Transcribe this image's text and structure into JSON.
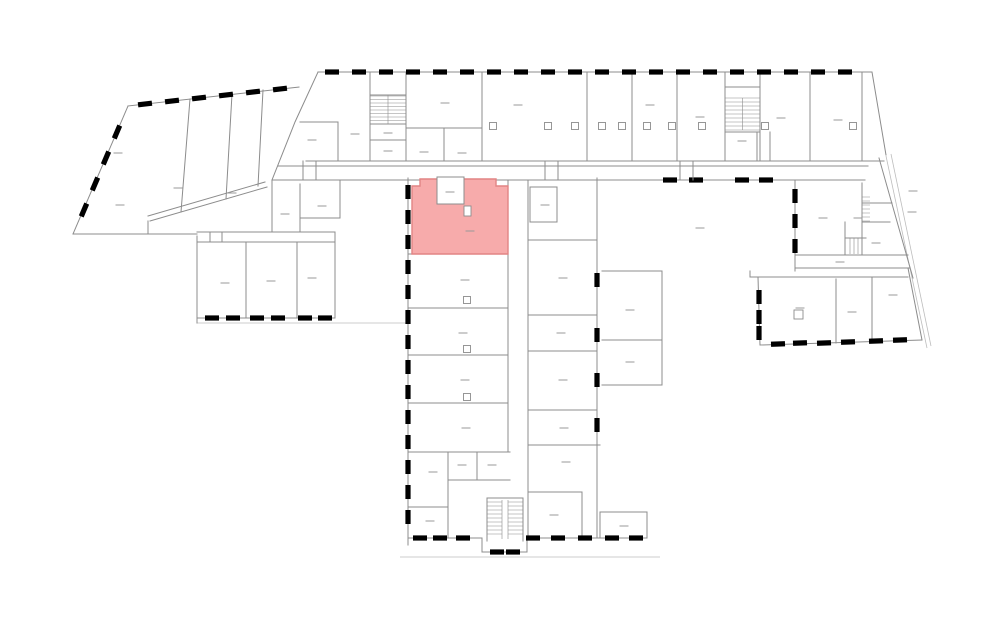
{
  "plan": {
    "type": "building-floor-plan",
    "description": "architectural floor plan with one selected room highlighted",
    "colors": {
      "background": "#ffffff",
      "line": "#8c8c8c",
      "faint": "#bdbdbd",
      "label": "#9a9a9a",
      "highlight_fill": "#f7abab",
      "highlight_stroke": "#e28484"
    },
    "highlight": {
      "name": "selected-room",
      "fill": "#f7abab",
      "stroke": "#e28484"
    },
    "features": {
      "staircases": 4,
      "wings": [
        "left-angled-wing",
        "top-strip",
        "central-wing",
        "right-wing",
        "bottom-right-wing"
      ],
      "selected_room_location": "central-wing-top"
    }
  }
}
